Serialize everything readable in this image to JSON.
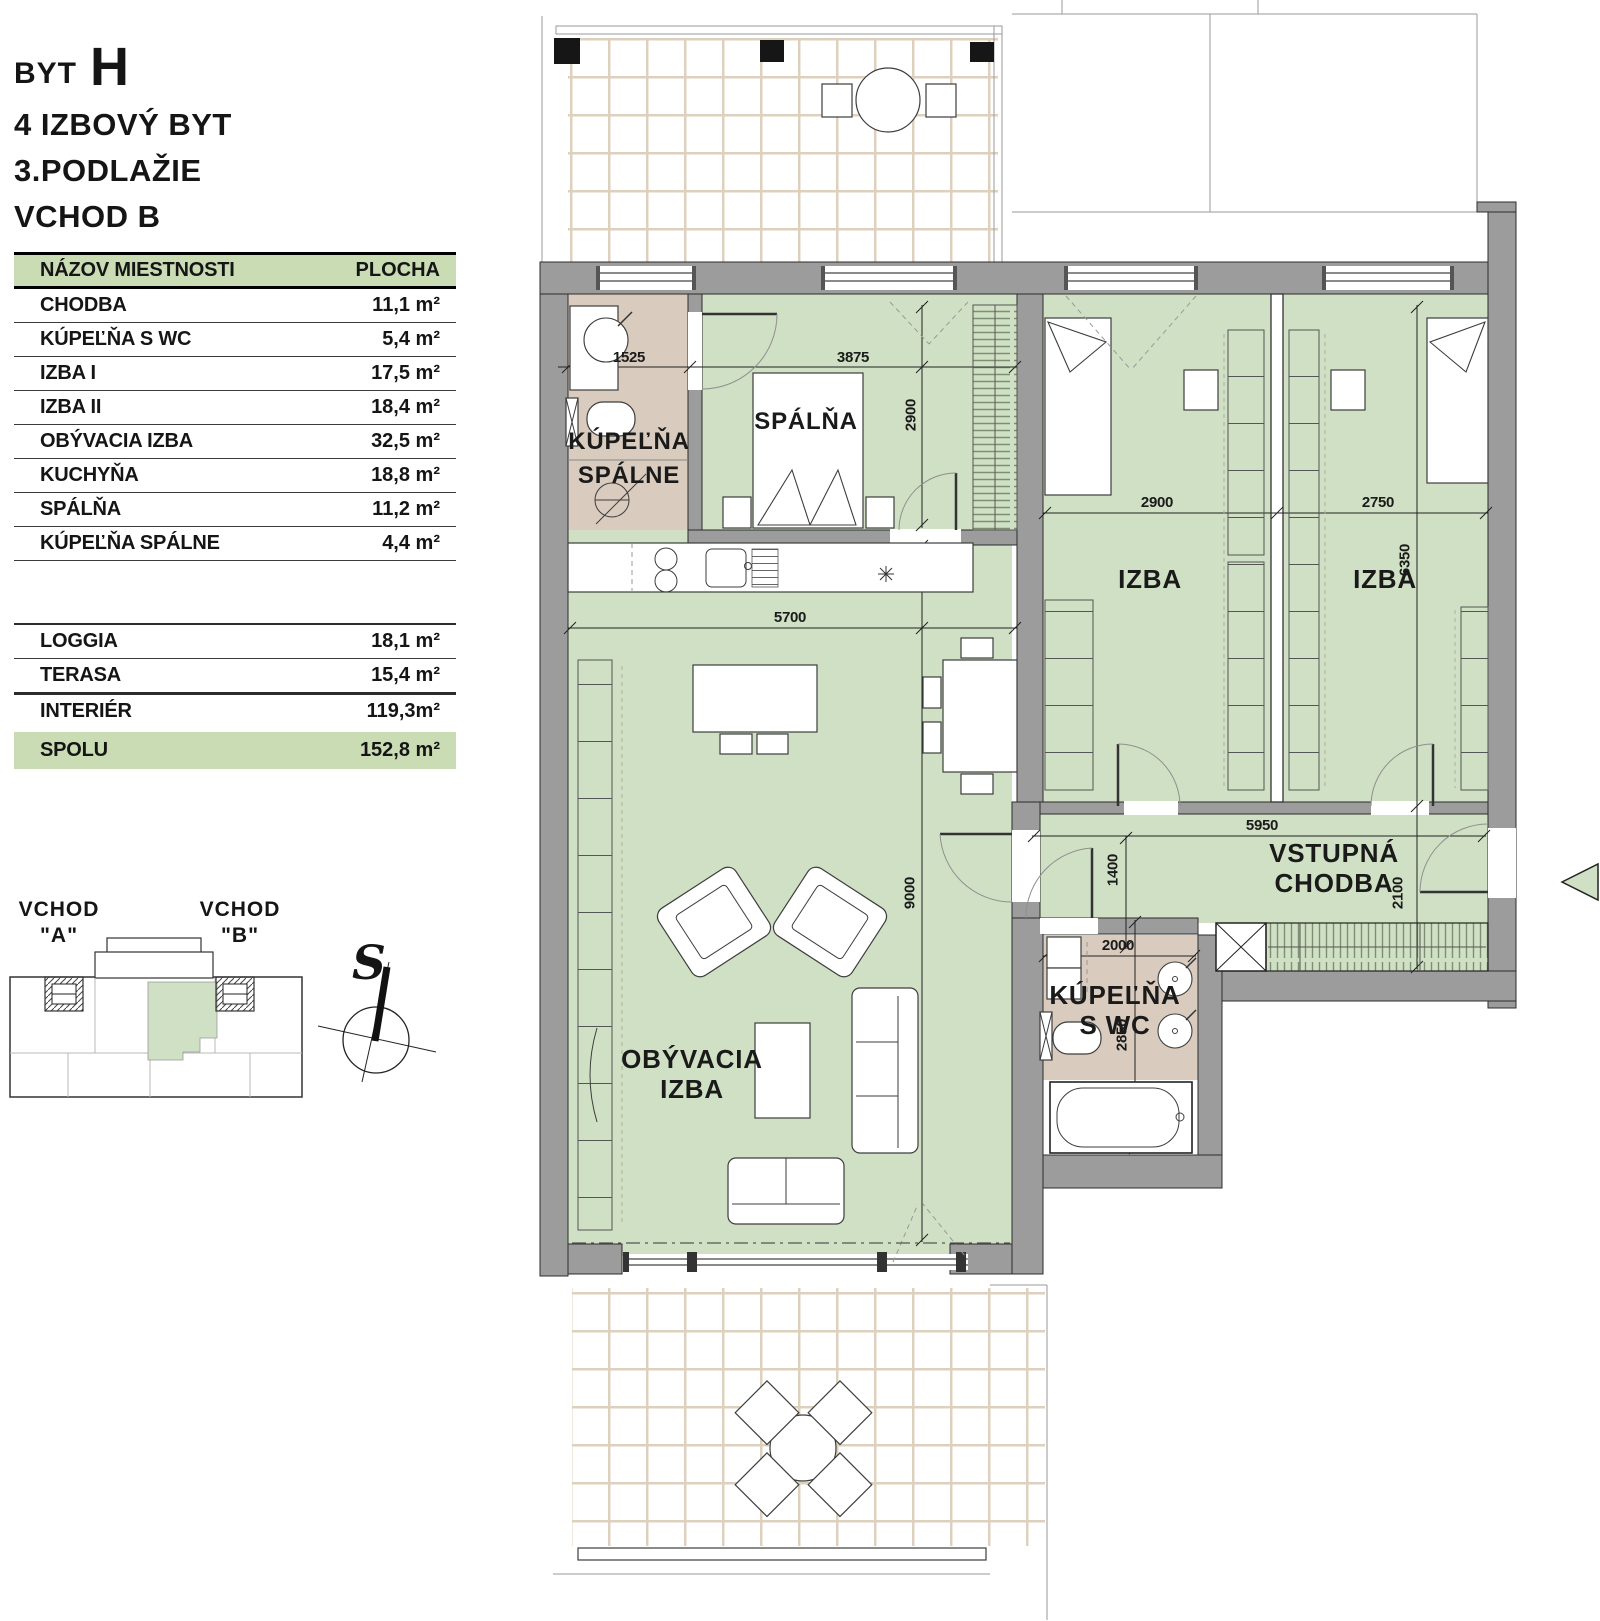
{
  "colors": {
    "room_green": "#cfe0c4",
    "bath_tan": "#d9ccbf",
    "wall_gray": "#9c9c9c",
    "accent_green": "#c9dcb3",
    "tile_line": "#ddd0bc"
  },
  "title": {
    "prefix": "BYT",
    "unit": "H",
    "type": "4 IZBOVÝ BYT",
    "floor": "3.PODLAŽIE",
    "entrance": "VCHOD B"
  },
  "area_table": {
    "header": {
      "name": "NÁZOV MIESTNOSTI",
      "area": "PLOCHA"
    },
    "rows": [
      {
        "name": "CHODBA",
        "area": "11,1 m²"
      },
      {
        "name": "KÚPEĽŇA S WC",
        "area": "5,4 m²"
      },
      {
        "name": "IZBA I",
        "area": "17,5 m²"
      },
      {
        "name": "IZBA II",
        "area": "18,4 m²"
      },
      {
        "name": "OBÝVACIA IZBA",
        "area": "32,5 m²"
      },
      {
        "name": "KUCHYŇA",
        "area": "18,8 m²"
      },
      {
        "name": "SPÁLŇA",
        "area": "11,2 m²"
      },
      {
        "name": "KÚPEĽŇA SPÁLNE",
        "area": "4,4 m²"
      }
    ],
    "outdoor_rows": [
      {
        "name": "LOGGIA",
        "area": "18,1 m²"
      },
      {
        "name": "TERASA",
        "area": "15,4 m²"
      },
      {
        "name": "INTERIÉR",
        "area": "119,3m²"
      }
    ],
    "total": {
      "name": "SPOLU",
      "area": "152,8 m²"
    }
  },
  "locator": {
    "entrance_a": "VCHOD",
    "entrance_a_q": "\"A\"",
    "entrance_b": "VCHOD",
    "entrance_b_q": "\"B\""
  },
  "compass": {
    "south": "S"
  },
  "plan": {
    "rooms": {
      "spalna": "SPÁLŇA",
      "izba": "IZBA",
      "kupelna_spalne_l1": "KÚPEĽŇA",
      "kupelna_spalne_l2": "SPÁLNE",
      "obyvacia_l1": "OBÝVACIA",
      "obyvacia_l2": "IZBA",
      "vstupna_l1": "VSTUPNÁ",
      "vstupna_l2": "CHODBA",
      "kupelna_wc_l1": "KÚPEĽŇA",
      "kupelna_wc_l2": "S WC"
    },
    "dimensions": {
      "bath1_width": "1525",
      "spalna_width": "3875",
      "spalna_depth": "2900",
      "izba1_width": "2900",
      "izba2_width": "2750",
      "izba_depth": "6350",
      "living_width": "5700",
      "living_depth": "9000",
      "hall_width": "5950",
      "hall_passage": "1400",
      "hall_depth": "2100",
      "bath2_width": "2000",
      "bath2_depth": "2850"
    }
  }
}
